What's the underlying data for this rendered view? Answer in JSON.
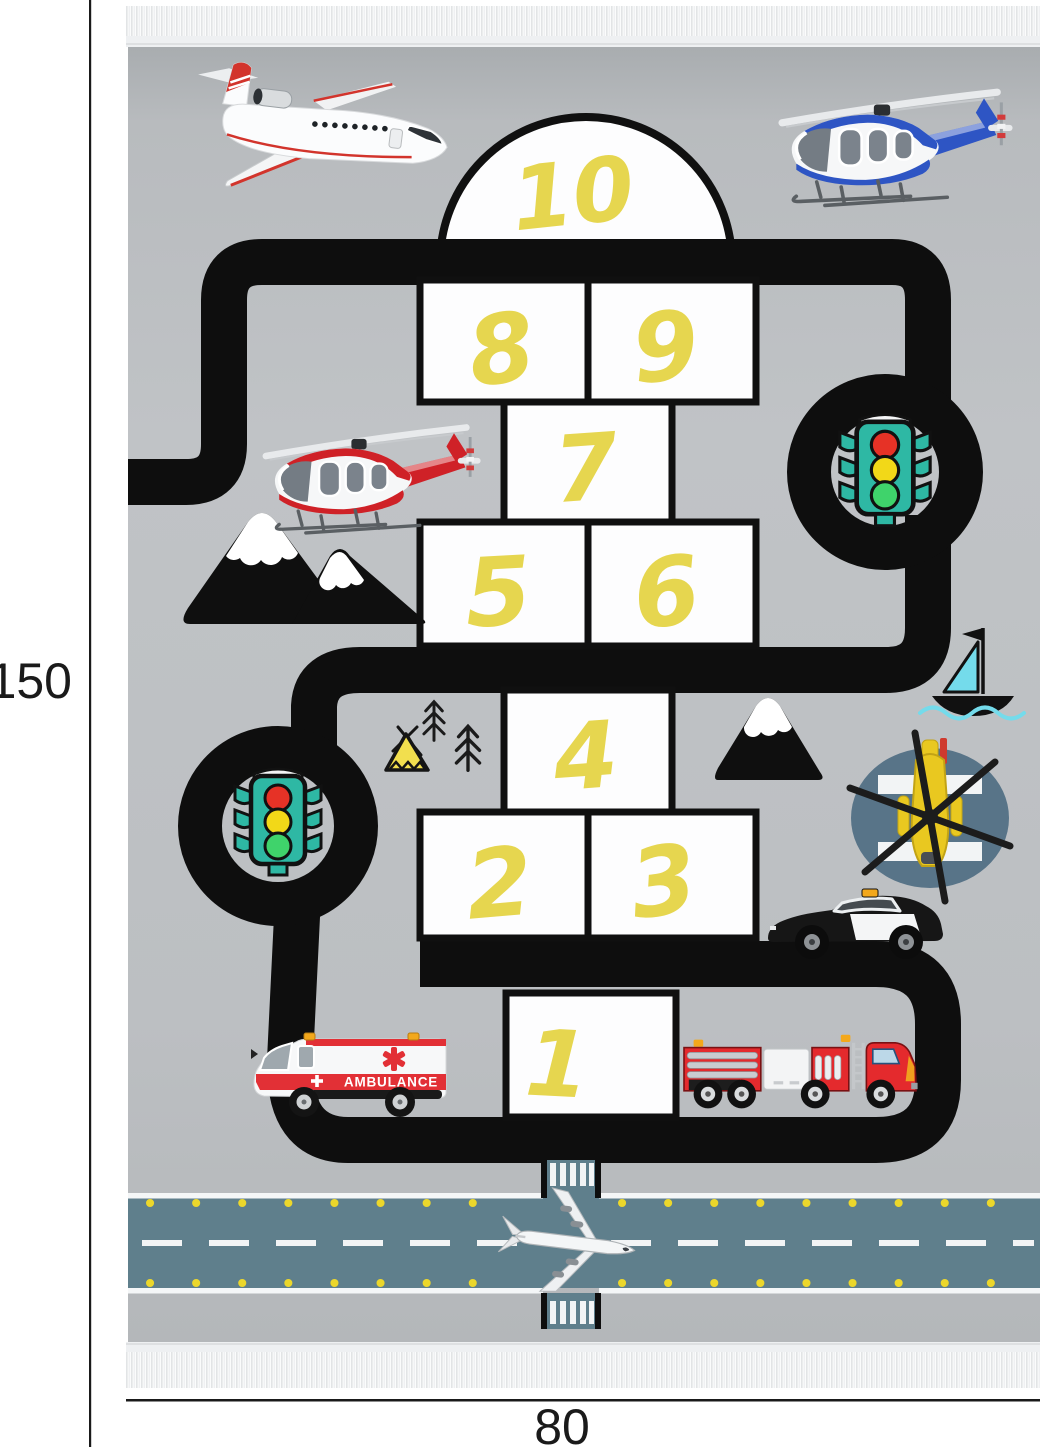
{
  "dimensions": {
    "height_label": "150",
    "width_label": "80"
  },
  "hopscotch": {
    "numbers": [
      "1",
      "2",
      "3",
      "4",
      "5",
      "6",
      "7",
      "8",
      "9",
      "10"
    ]
  },
  "ambulance": {
    "label": "AMBULANCE"
  },
  "icons": [
    "jet-plane-icon",
    "helicopter-blue-icon",
    "helicopter-red-icon",
    "traffic-light-icon",
    "roundabout-icon",
    "mountains-icon",
    "tent-icon",
    "pine-tree-icon",
    "sailboat-icon",
    "rescue-helicopter-helipad-icon",
    "police-car-icon",
    "ambulance-icon",
    "fire-truck-icon",
    "runway-airplane-icon",
    "zebra-crossing-icon",
    "fringe"
  ],
  "colors": {
    "rug_gray": "#bcbfc2",
    "road_black": "#0e0e0e",
    "number_yellow": "#e6d64f",
    "runway_slate": "#5f7f8c",
    "helipad_slate": "#587488",
    "traffic_light_teal": "#2eb8a4",
    "lamp_red": "#e63226",
    "lamp_yellow": "#f2d818",
    "lamp_green": "#3fd36b",
    "ambulance_red": "#e23036",
    "fire_truck_red": "#e42a2d",
    "sail_cyan": "#74dbeb",
    "tent_yellow": "#f2df4e",
    "runway_dot_yellow": "#ecd72b"
  }
}
